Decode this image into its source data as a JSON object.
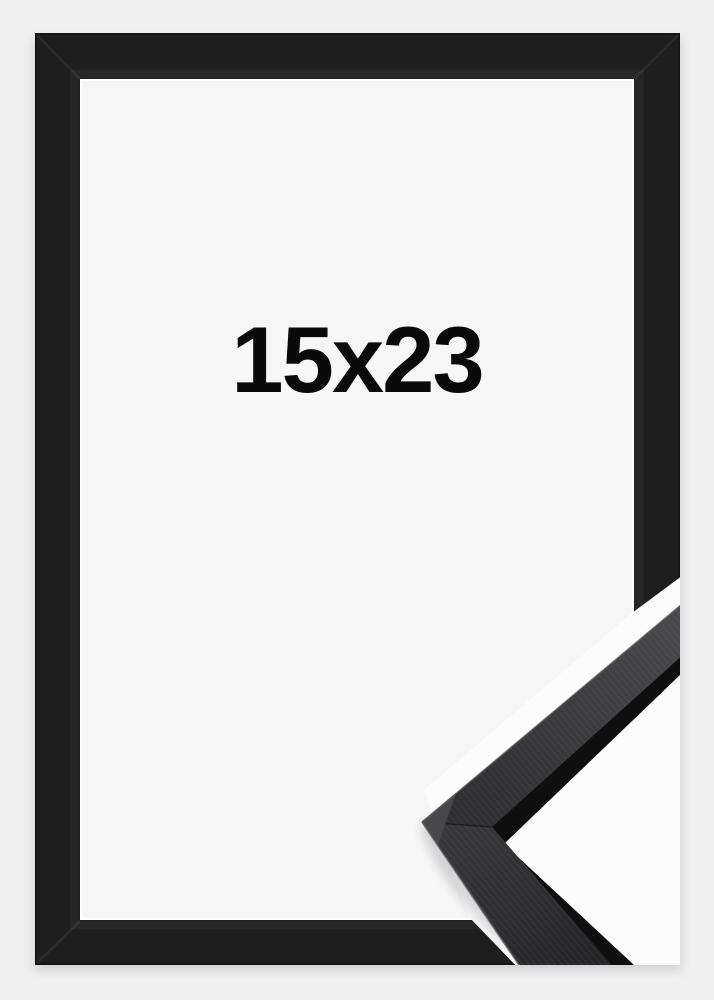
{
  "product": {
    "size_label": "15x23"
  },
  "colors": {
    "background": "#f0f0f1",
    "frame": "#1e1e1f",
    "frame_outer_line": "#151516",
    "frame_inner_bevel": "#272728",
    "opening_background": "#f6f6f7",
    "opening_lip": "#ffffff",
    "cut_gap": "#fcfcfd",
    "sample_silhouette": "#0f0f10",
    "label_text": "#0a0a0b"
  }
}
